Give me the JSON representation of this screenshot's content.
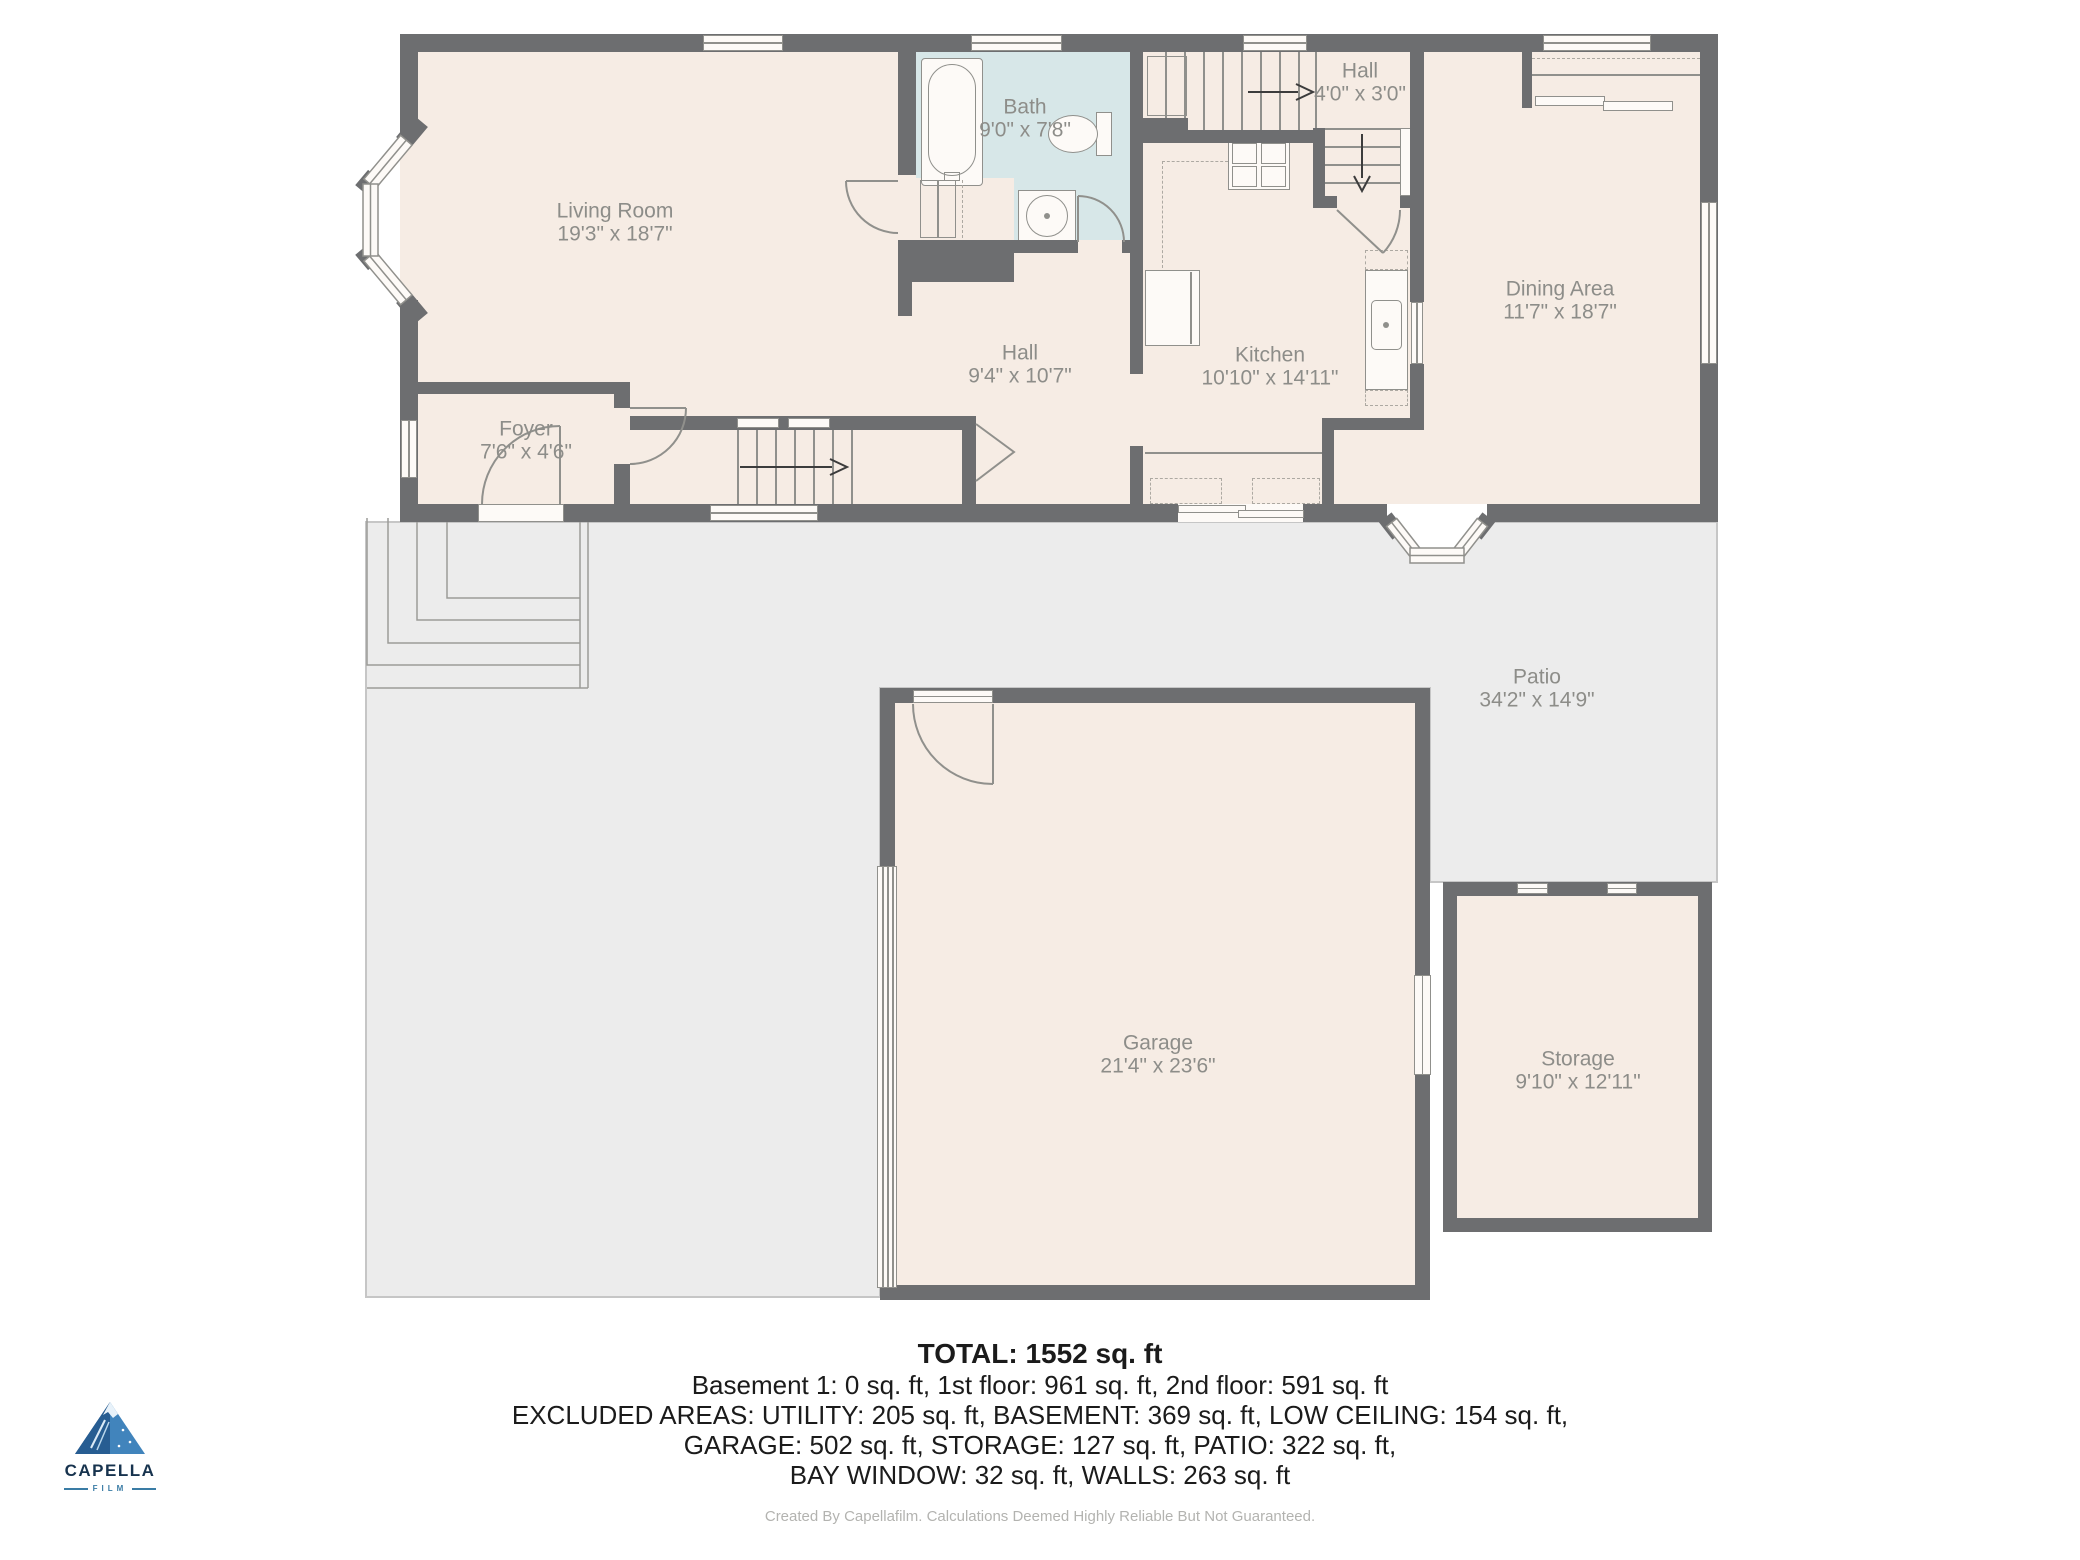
{
  "rooms": {
    "living_room": {
      "name": "Living Room",
      "dims": "19'3\" x 18'7\""
    },
    "bath": {
      "name": "Bath",
      "dims": "9'0\" x 7'8\""
    },
    "hall_upper": {
      "name": "Hall",
      "dims": "4'0\" x 3'0\""
    },
    "dining": {
      "name": "Dining Area",
      "dims": "11'7\" x 18'7\""
    },
    "kitchen": {
      "name": "Kitchen",
      "dims": "10'10\" x 14'11\""
    },
    "hall_lower": {
      "name": "Hall",
      "dims": "9'4\" x 10'7\""
    },
    "foyer": {
      "name": "Foyer",
      "dims": "7'6\" x 4'6\""
    },
    "patio": {
      "name": "Patio",
      "dims": "34'2\" x 14'9\""
    },
    "garage": {
      "name": "Garage",
      "dims": "21'4\" x 23'6\""
    },
    "storage": {
      "name": "Storage",
      "dims": "9'10\" x 12'11\""
    }
  },
  "summary": {
    "total": "TOTAL: 1552 sq. ft",
    "line2": "Basement 1: 0 sq. ft, 1st floor: 961 sq. ft, 2nd floor: 591 sq. ft",
    "line3": "EXCLUDED AREAS: UTILITY: 205 sq. ft, BASEMENT: 369 sq. ft, LOW CEILING: 154 sq. ft,",
    "line4": "GARAGE: 502 sq. ft, STORAGE: 127 sq. ft, PATIO: 322 sq. ft,",
    "line5": "BAY WINDOW: 32 sq. ft, WALLS: 263 sq. ft"
  },
  "footer": {
    "disclaimer": "Created By Capellafilm. Calculations Deemed Highly Reliable But Not Guaranteed."
  },
  "logo": {
    "brand": "CAPELLA",
    "sub": "FILM"
  },
  "colors": {
    "wall": "#6d6e70",
    "room_fill": "#f6ece4",
    "bath_fill": "#d7e7e8",
    "patio_fill": "#ececec",
    "patio_border": "#c6c6c6",
    "label_text": "#8d8d89",
    "logo_navy": "#17334e",
    "logo_blue": "#3a7ca5"
  }
}
